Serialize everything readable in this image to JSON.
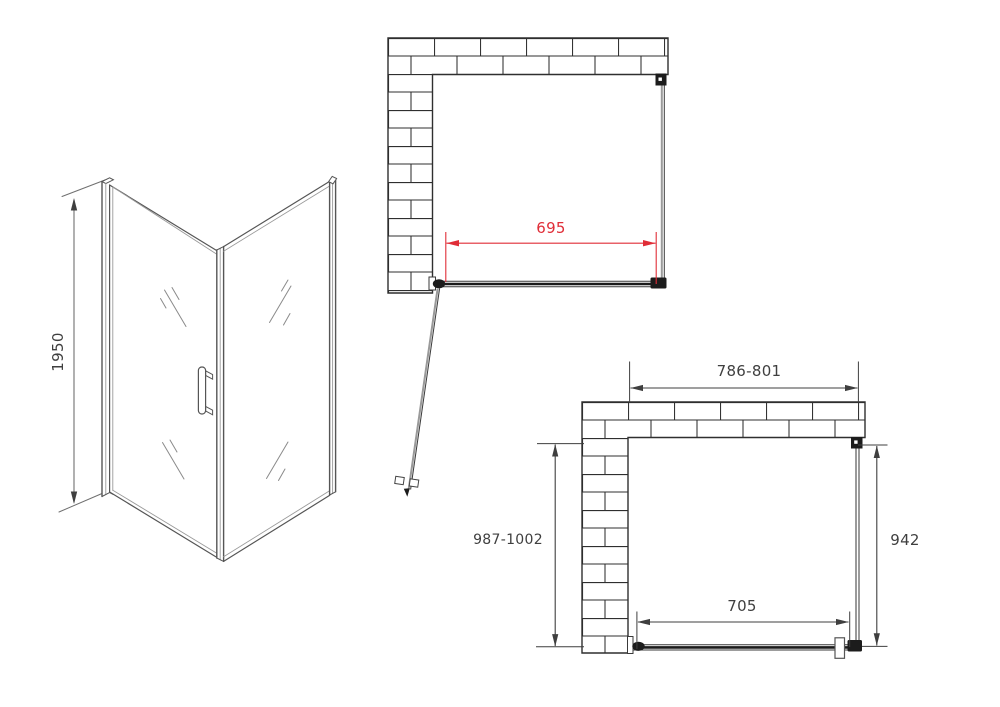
{
  "drawing": {
    "views": {
      "perspective": {
        "height_mm": "1950"
      },
      "plan_open_door": {
        "door_width_mm": "695"
      },
      "plan_closed_door": {
        "opening_width_mm": "786-801",
        "total_depth_mm": "987-1002",
        "side_panel_mm": "942",
        "door_width_mm": "705"
      }
    },
    "colors": {
      "background": "#ffffff",
      "line": "#3f3f3f",
      "dimension_accent": "#e02d37"
    }
  }
}
